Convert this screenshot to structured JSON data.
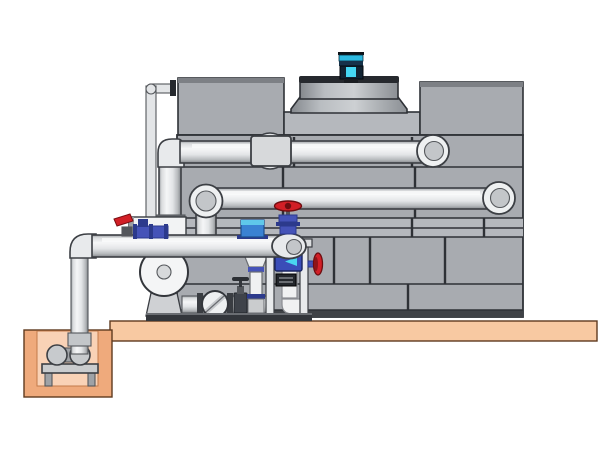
{
  "scene": {
    "description": "cooling-tower-and-pump-skid-piping-diagram",
    "components": [
      {
        "name": "fan-motor",
        "color_ref": "motor_cyan"
      },
      {
        "name": "fan-shroud",
        "color_ref": "drum_dark"
      },
      {
        "name": "cooling-tower-casing",
        "color_ref": "tower_panel"
      },
      {
        "name": "top-supply-pipe",
        "color_ref": "pipe_light"
      },
      {
        "name": "middle-return-pipe",
        "color_ref": "pipe_light"
      },
      {
        "name": "pump-discharge-pipe",
        "color_ref": "pipe_light"
      },
      {
        "name": "gate-valve-red-handwheel",
        "color_ref": "valve_red"
      },
      {
        "name": "butterfly-valve",
        "color_ref": "valve_blue"
      },
      {
        "name": "inline-flow-meter",
        "color_ref": "fitting_blue"
      },
      {
        "name": "strainer-cone",
        "color_ref": "valve_blue"
      },
      {
        "name": "check-valve",
        "color_ref": "white_metal"
      },
      {
        "name": "pump-volute",
        "color_ref": "white_metal"
      },
      {
        "name": "instrument-display",
        "color_ref": "display_blue"
      },
      {
        "name": "side-handwheel-valve",
        "color_ref": "valve_red"
      },
      {
        "name": "concrete-platform",
        "color_ref": "platform"
      },
      {
        "name": "sump-pit",
        "color_ref": "pit_wall"
      },
      {
        "name": "sump-pump",
        "color_ref": "metal_mid"
      },
      {
        "name": "sump-riser-pipe",
        "color_ref": "pipe_light"
      },
      {
        "name": "makeup-line-thin-pipe",
        "color_ref": "pipe_light"
      }
    ]
  },
  "colors": {
    "background": "#ffffff",
    "tower_panel": "#a8abb0",
    "tower_panel_light": "#b5b8bd",
    "tower_cap": "#7d8085",
    "tower_base": "#3f4246",
    "pipe_light": "#f5f6f7",
    "pipe_mid": "#dcdee0",
    "pipe_shadow": "#84878b",
    "pipe_body": "#e8eaec",
    "elbow_face": "#eef0f1",
    "elbow_inner": "#c3c6c9",
    "platform": "#f8c9a2",
    "pit_wall": "#efaa7c",
    "pit_inner": "#f9d2b6",
    "motor_cyan": "#2bb8e0",
    "motor_cyan_bright": "#45d8f4",
    "motor_dark": "#122433",
    "drum_dark": "#26292e",
    "valve_blue": "#4553b8",
    "valve_blue_dark": "#2c3a8c",
    "valve_red": "#d21f26",
    "fitting_blue": "#3a82d2",
    "fitting_cyan": "#5fc8ea",
    "display_blue": "#3a4db8",
    "display_arrow": "#49d6f0",
    "metal_dark": "#3a3d42",
    "metal_mid": "#caccce",
    "white_metal": "#f2f3f4"
  }
}
